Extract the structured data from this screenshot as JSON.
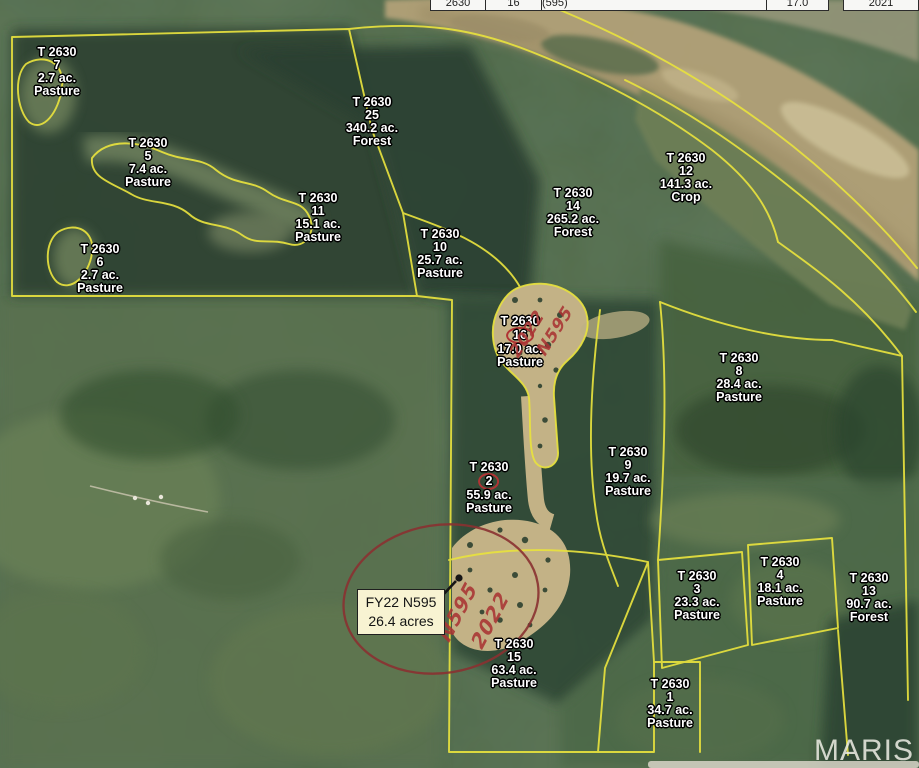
{
  "header_bar": {
    "cells": [
      {
        "label": "2630"
      },
      {
        "label": "16"
      },
      {
        "label": "Pest Management Conservation System (595)"
      },
      {
        "label": "17.0"
      },
      {
        "label": "2021"
      }
    ]
  },
  "map": {
    "parcels": [
      {
        "tract": "T 2630",
        "number": "7",
        "acres": "2.7 ac.",
        "use": "Pasture"
      },
      {
        "tract": "T 2630",
        "number": "5",
        "acres": "7.4 ac.",
        "use": "Pasture"
      },
      {
        "tract": "T 2630",
        "number": "25",
        "acres": "340.2 ac.",
        "use": "Forest"
      },
      {
        "tract": "T 2630",
        "number": "11",
        "acres": "15.1 ac.",
        "use": "Pasture"
      },
      {
        "tract": "T 2630",
        "number": "6",
        "acres": "2.7 ac.",
        "use": "Pasture"
      },
      {
        "tract": "T 2630",
        "number": "10",
        "acres": "25.7 ac.",
        "use": "Pasture"
      },
      {
        "tract": "T 2630",
        "number": "14",
        "acres": "265.2 ac.",
        "use": "Forest"
      },
      {
        "tract": "T 2630",
        "number": "12",
        "acres": "141.3 ac.",
        "use": "Crop"
      },
      {
        "tract": "T 2630",
        "number": "16",
        "acres": "17.0 ac.",
        "use": "Pasture"
      },
      {
        "tract": "T 2630",
        "number": "8",
        "acres": "28.4 ac.",
        "use": "Pasture"
      },
      {
        "tract": "T 2630",
        "number": "9",
        "acres": "19.7 ac.",
        "use": "Pasture"
      },
      {
        "tract": "T 2630",
        "number": "2",
        "acres": "55.9 ac.",
        "use": "Pasture"
      },
      {
        "tract": "T 2630",
        "number": "3",
        "acres": "23.3 ac.",
        "use": "Pasture"
      },
      {
        "tract": "T 2630",
        "number": "4",
        "acres": "18.1 ac.",
        "use": "Pasture"
      },
      {
        "tract": "T 2630",
        "number": "13",
        "acres": "90.7 ac.",
        "use": "Forest"
      },
      {
        "tract": "T 2630",
        "number": "15",
        "acres": "63.4 ac.",
        "use": "Pasture"
      },
      {
        "tract": "T 2630",
        "number": "1",
        "acres": "34.7 ac.",
        "use": "Pasture"
      }
    ],
    "callout": {
      "line1": "FY22 N595",
      "line2": "26.4 acres"
    },
    "annotations": {
      "handwriting_tract16": [
        "2022",
        "N595"
      ],
      "handwriting_callout": [
        "N595",
        "2022"
      ],
      "circled_tract_numbers": [
        "16",
        "2"
      ],
      "ink_color": "#a93434"
    },
    "watermark": "MARIS",
    "colors": {
      "boundary_yellow": "#e8e23e",
      "label_text": "#ffffff",
      "callout_background": "#f8f3d2",
      "annotation_red": "#a93434",
      "river_tan": "#b2a178"
    }
  }
}
